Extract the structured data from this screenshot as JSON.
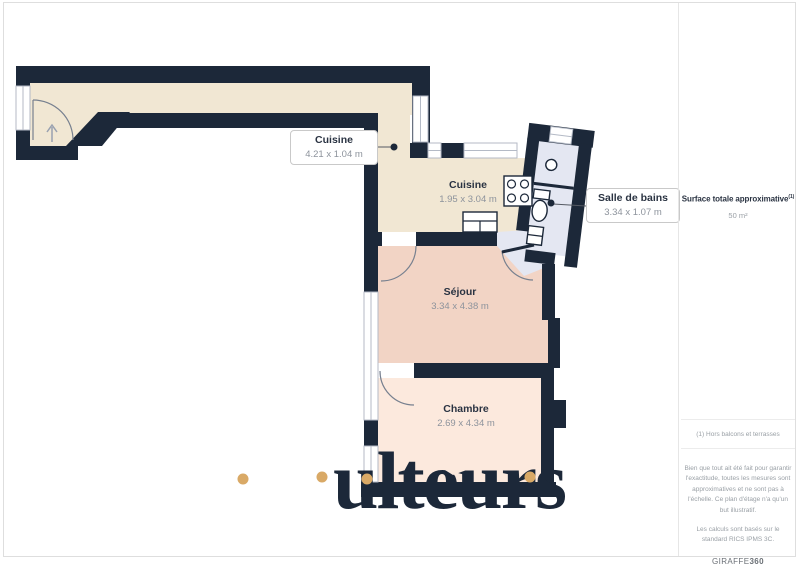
{
  "plan": {
    "corridor_label": {
      "name": "Cuisine",
      "dims": "4.21 x 1.04 m"
    },
    "kitchen_label": {
      "name": "Cuisine",
      "dims": "1.95 x 3.04 m"
    },
    "bathroom_label": {
      "name": "Salle de bains",
      "dims": "3.34 x 1.07 m"
    },
    "sejour_label": {
      "name": "Séjour",
      "dims": "3.34 x 4.38 m"
    },
    "chambre_label": {
      "name": "Chambre",
      "dims": "2.69 x 4.34 m"
    },
    "colors": {
      "wall": "#1c2839",
      "corridor": "#f1e7d3",
      "kitchen": "#f1e7d3",
      "sejour": "#f2d4c5",
      "chambre": "#fce9dd",
      "bathroom": "#e4e7f2",
      "accent_dots": "#d9a966"
    }
  },
  "sidebar": {
    "surface_label": "Surface totale approximative",
    "surface_sup": "(1)",
    "surface_value": "50 m²",
    "footnote": "(1) Hors balcons et terrasses",
    "disclaimer": "Bien que tout ait été fait pour garantir l'exactitude, toutes les mesures sont approximatives et ne sont pas à l'échelle. Ce plan d'étage n'a qu'un but illustratif.",
    "standard": "Les calculs sont basés sur le standard RICS IPMS 3C.",
    "brand": "GIRAFFE",
    "brand_suffix": "360"
  },
  "watermark": {
    "text": "ulteurs"
  }
}
